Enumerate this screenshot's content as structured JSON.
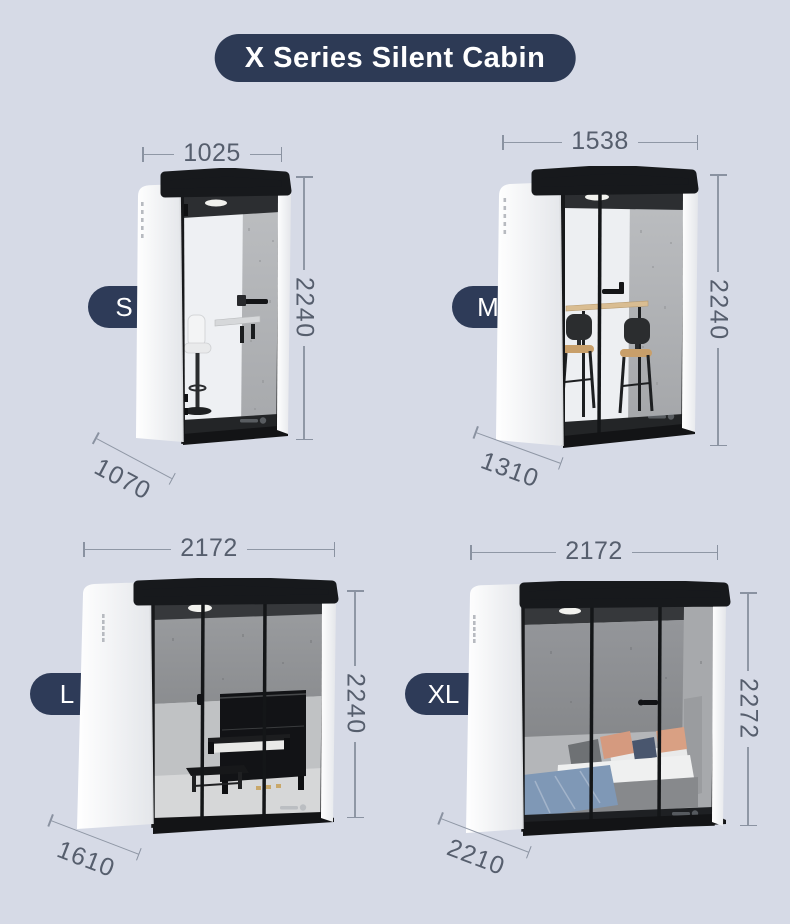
{
  "title": "X Series Silent Cabin",
  "colors": {
    "background": "#d6dae6",
    "navy": "#2d3a55",
    "dim_line": "#8f97a5",
    "dim_text": "#565e6d",
    "cabin_white": "#f8f9fa",
    "frame_black": "#17191c",
    "felt_gray": "#b2b4b6"
  },
  "cabins": [
    {
      "size_label": "S",
      "width_mm": "1025",
      "height_mm": "2240",
      "depth_mm": "1070"
    },
    {
      "size_label": "M",
      "width_mm": "1538",
      "height_mm": "2240",
      "depth_mm": "1310"
    },
    {
      "size_label": "L",
      "width_mm": "2172",
      "height_mm": "2240",
      "depth_mm": "1610"
    },
    {
      "size_label": "XL",
      "width_mm": "2172",
      "height_mm": "2272",
      "depth_mm": "2210"
    }
  ]
}
